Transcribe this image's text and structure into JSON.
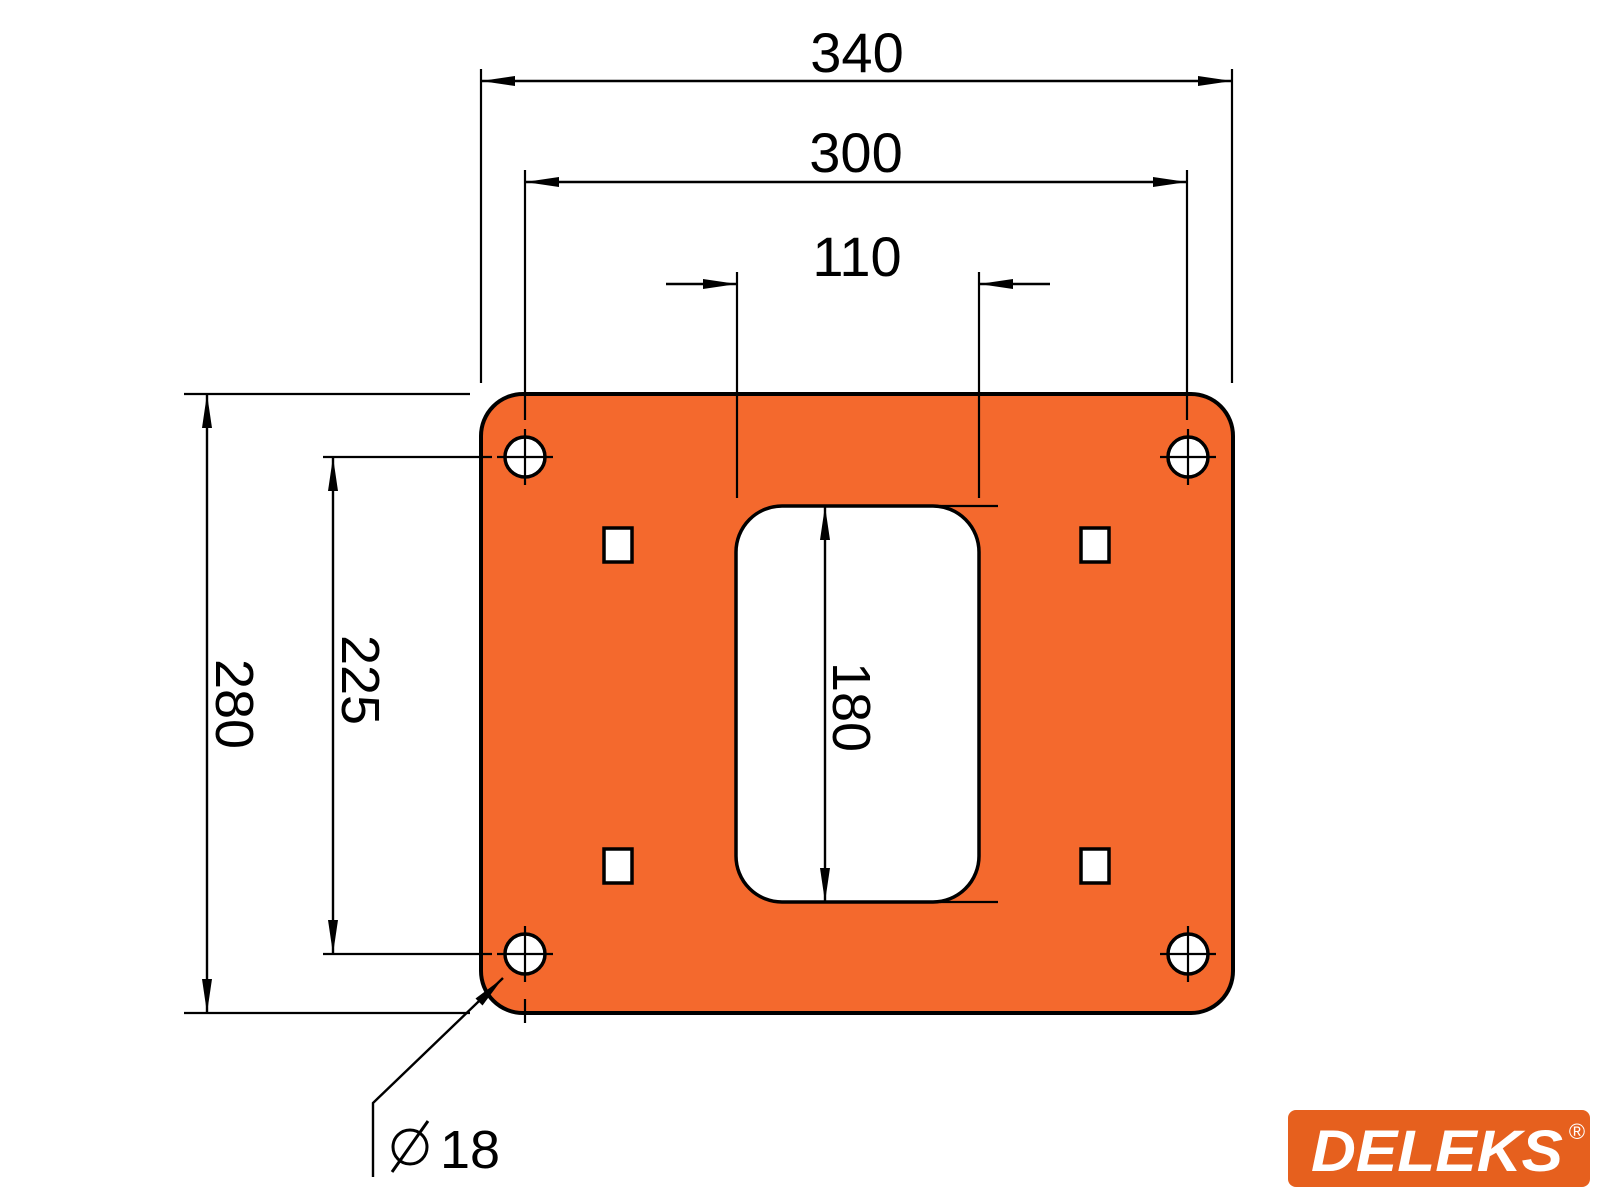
{
  "drawing": {
    "dimensions": {
      "overall_width": "340",
      "hole_pitch_horizontal": "300",
      "slot_width": "110",
      "overall_height": "280",
      "hole_pitch_vertical": "225",
      "slot_height": "180",
      "hole_diameter": "18"
    }
  },
  "logo": {
    "text": "DELEKS",
    "registered_mark": "®"
  },
  "colors": {
    "plate_fill": "#F4692D",
    "logo_fill": "#E6601E",
    "line": "#000000",
    "cut_fill": "#FFFFFF",
    "background": "#FFFFFF"
  }
}
